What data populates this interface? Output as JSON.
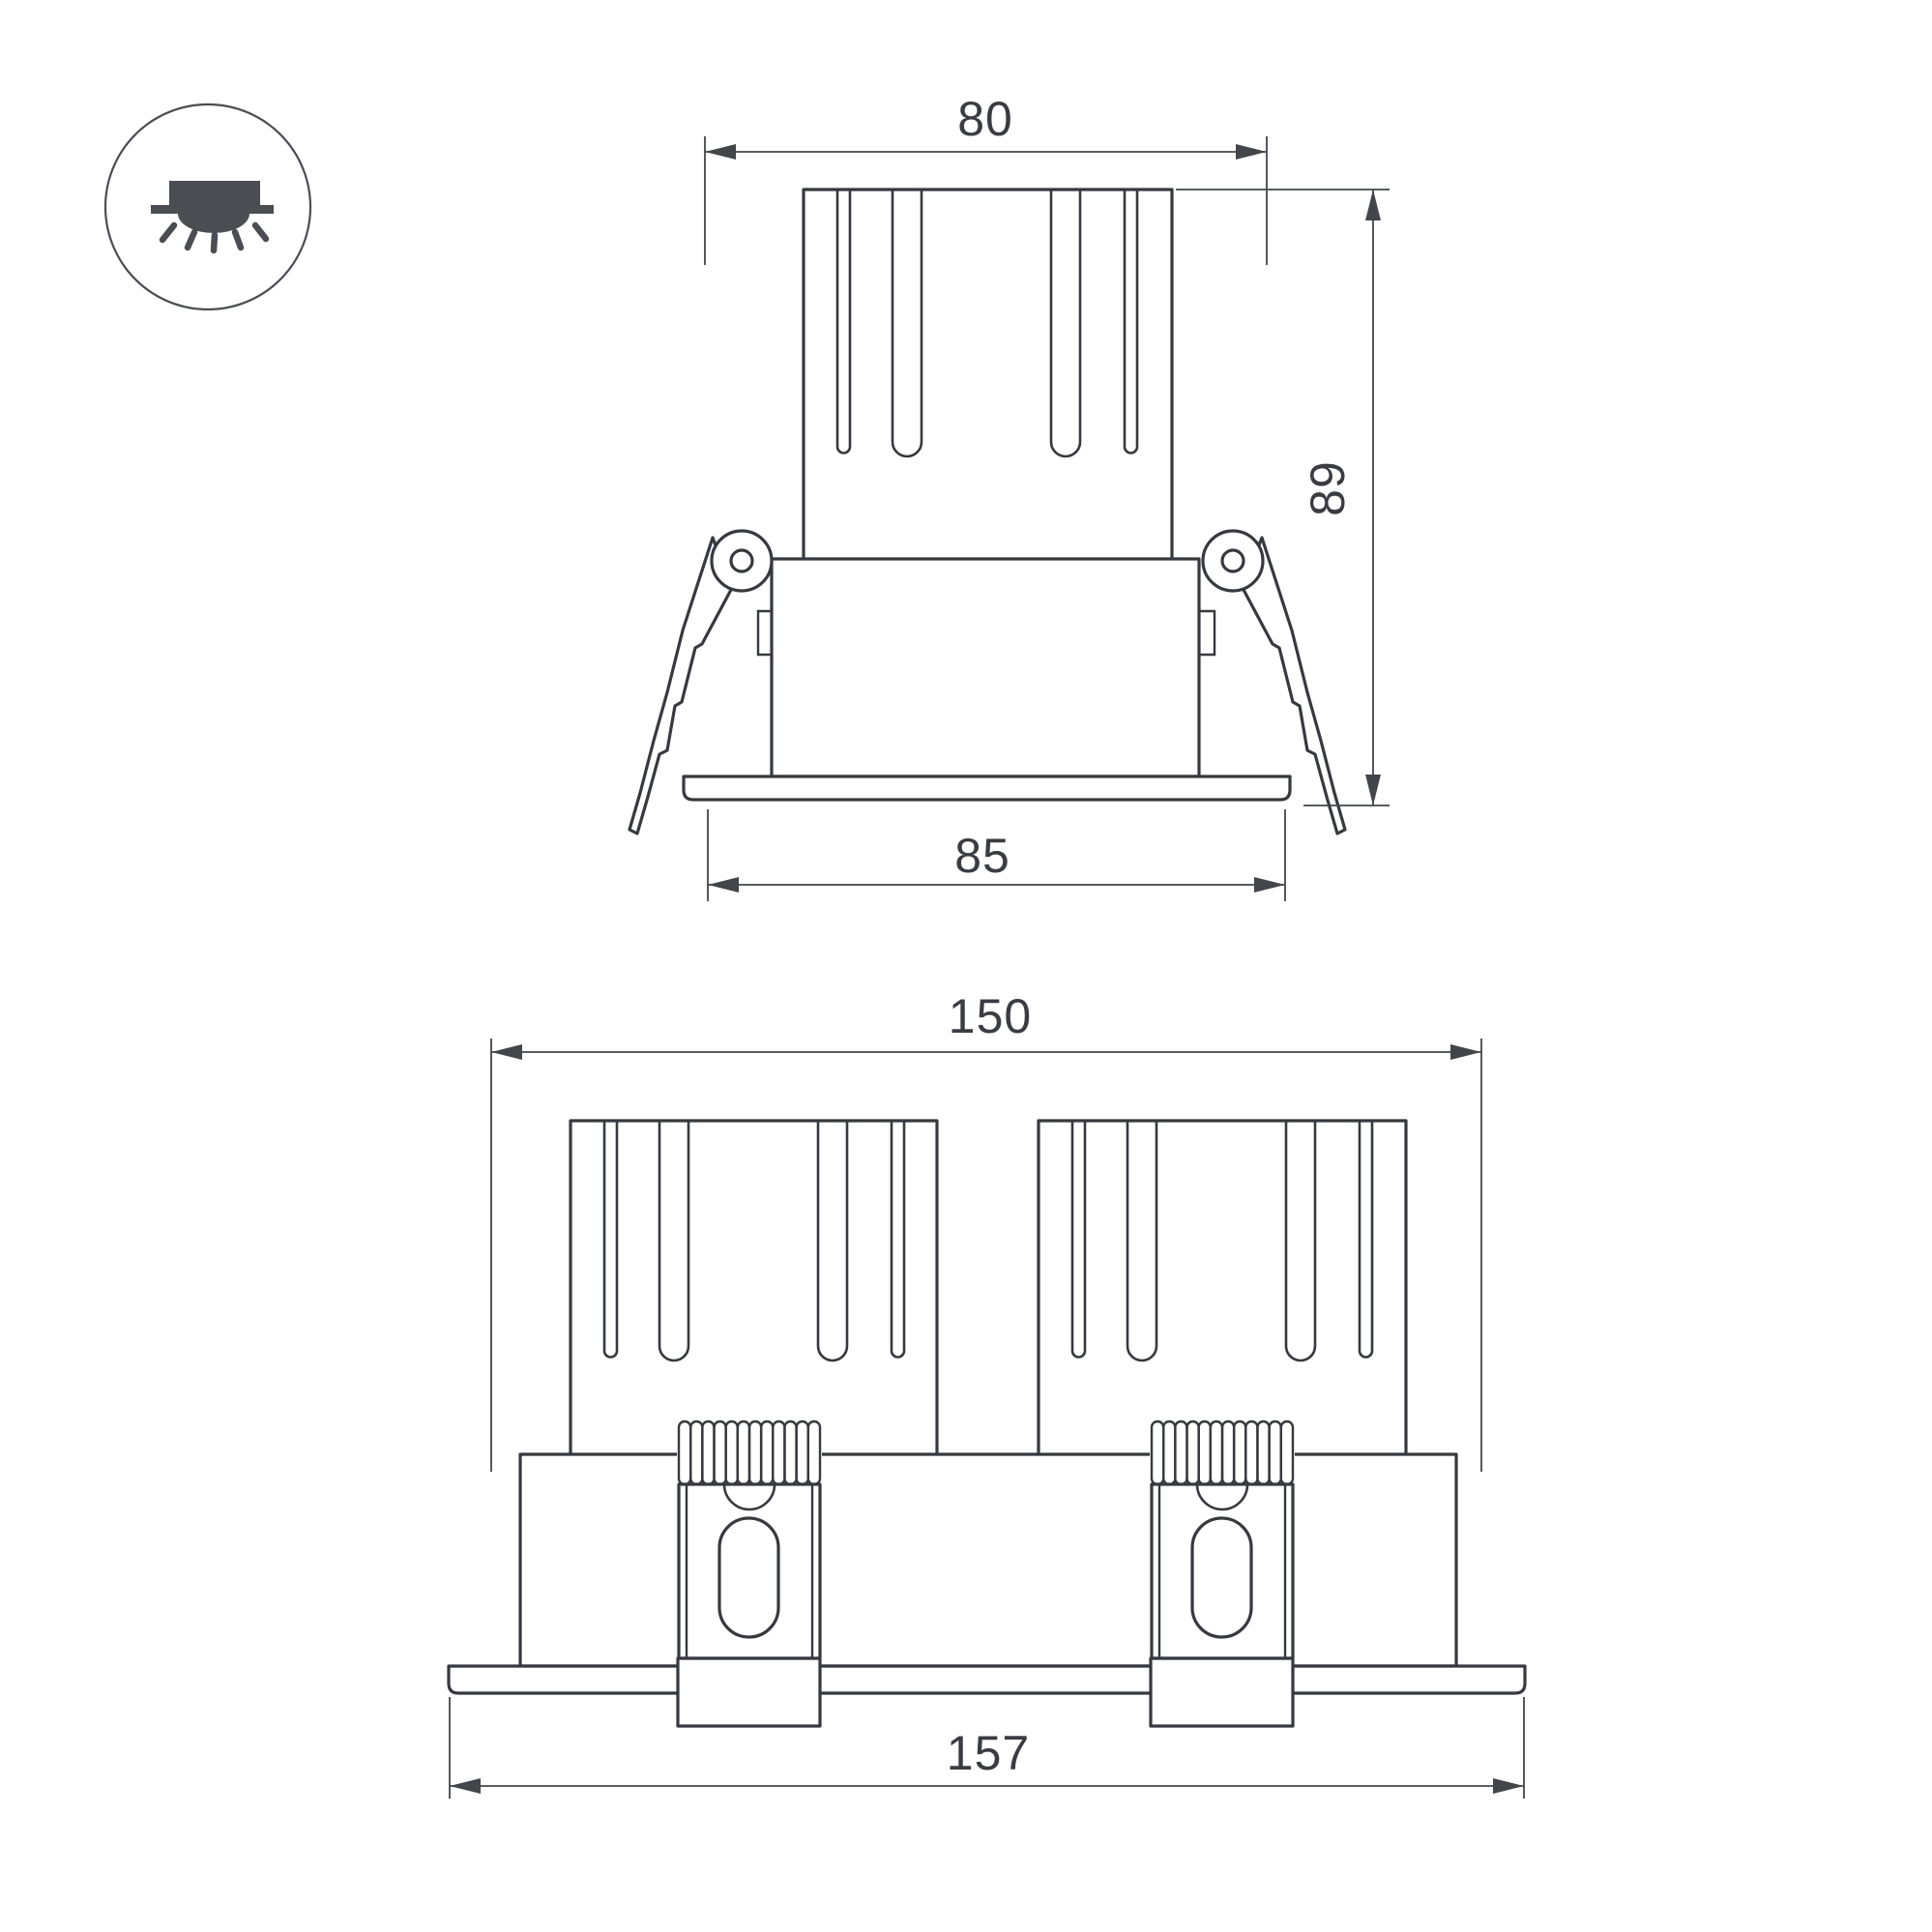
{
  "icon": {
    "name": "recessed-downlight-icon"
  },
  "colors": {
    "line": "#37393e",
    "dimension_line": "#43454a",
    "icon_fill": "#4b4d52",
    "background": "#ffffff"
  },
  "figure_top": {
    "name": "single-unit-front-view",
    "dim_top_width": "80",
    "dim_height": "89",
    "dim_flange_width": "85"
  },
  "figure_bottom": {
    "name": "double-unit-front-view",
    "dim_top_width": "150",
    "dim_flange_width": "157"
  }
}
